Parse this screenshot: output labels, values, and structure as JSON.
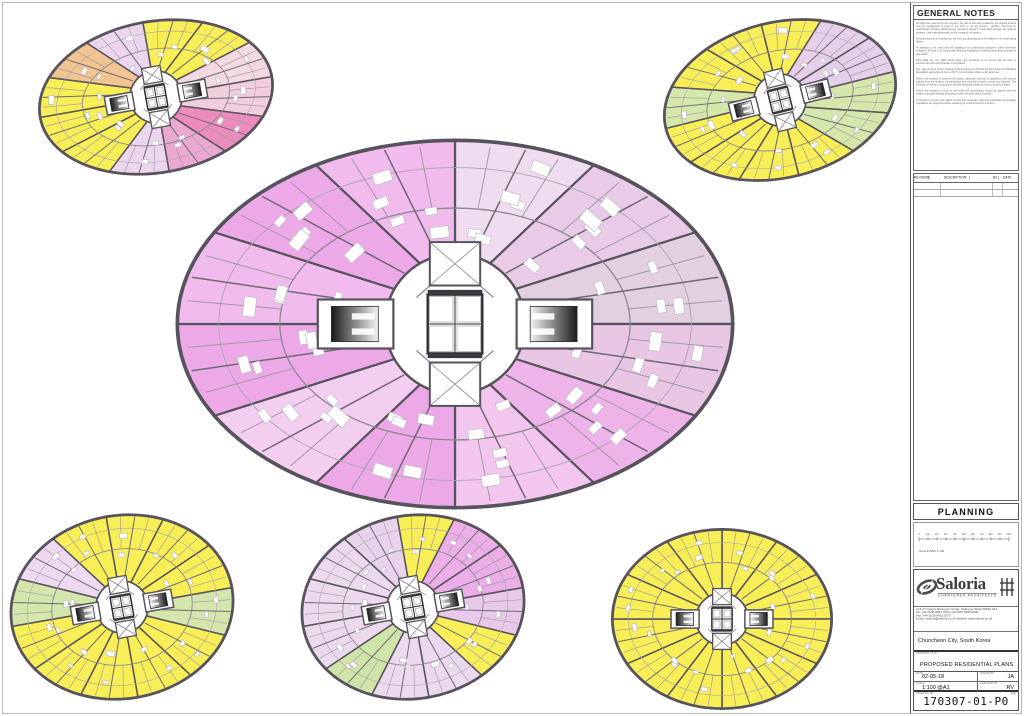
{
  "general_notes": {
    "title": "GENERAL NOTES",
    "paragraphs": [
      "All rights are reserved by the company. No part of this work created by the original artwork may be reproduced or used in any form or by any means - graphic, electronic or mechanical, including photocopying, recording, taping or information storage and retrieval systems - with right permission of the company concerned.",
      "All dimensions to be checked on site and any discrepancy to be notified to the supervising officer.",
      "All attention to be noted that this drawing is for construction purposes unless otherwise indicated. All work is to comply with Building Regulations including amendments made to date 2010.",
      "Party Wall etc. Act 1996 would apply any contractor is to ensure that all work is commenced with this schedule is completed.",
      "The main purpose of this drawing is the procurement of Planning Permission and Building Regulation approval and form a NOT to construction unless work approved.",
      "Where this property is used for the works, particulars should be acquired at the time of enquiry from the landlord, full particulars and schedule of work to avoid any disputes. The schedule of works in conjunction with the drawings should be used to resolve matters.",
      "Where this drawing is used for the works full specification should be agreed with the builder to include heating, plumbing & other services where required.",
      "Contractor to ensure that safety checks that necessary planning particulars and building regulations are approved before tendering or commencement of works."
    ]
  },
  "revision_table": {
    "columns": [
      "REVISION",
      "DESCRIPTION",
      "BY",
      "DATE"
    ]
  },
  "planning_label": "PLANNING",
  "scalebar": {
    "labels": [
      "0",
      "1m",
      "2m",
      "3m",
      "4m",
      "5m",
      "6m",
      "7m",
      "8m",
      "9m",
      "10m"
    ],
    "caption": "SCALE BAR 1:100"
  },
  "firm": {
    "name": "Saloria",
    "tagline": "CHARTERED ARCHITECTS",
    "address_line1": "Unit 27 Cygnus Business Centre, Dalmeyer Road NW10 2XA",
    "address_line2": "Tel:  +44 (020) 8451 7833    +44 (020) 8459 9600",
    "address_line3": "Fax: +44 (020) 8451 3375",
    "address_line4": "Email: l.saloria@saloria.co.uk    website: www.saloria.co.uk"
  },
  "project": {
    "location": "Chuncheon City, South Korea",
    "title_label": "DRAWING TITLE",
    "title": "PROPOSED  RESIDENTIAL  PLANS"
  },
  "fields": {
    "date_label": "DATE",
    "date": "02-05-18",
    "drawn_label": "DRAWN BY",
    "drawn": "JA",
    "scale_label": "SCALE",
    "scale": "1:100  @A1",
    "checked_label": "CHECKED BY",
    "checked": "RV",
    "number_label": "DRAWING NO",
    "rev_label": "REV",
    "drawing_number": "170307-01-P0"
  },
  "colors": {
    "wall": "#57535c",
    "yellow": "#f7ec55"
  },
  "plans": [
    {
      "name": "floor-plan-top-left",
      "cx": 156,
      "cy": 97,
      "rx": 118,
      "ry": 76,
      "rot": -10,
      "rc": 26,
      "big": false,
      "wedges": [
        [
          -90,
          -60,
          "#f8ee57"
        ],
        [
          -60,
          -30,
          "#f8ee57"
        ],
        [
          -30,
          0,
          "#f3d9e2"
        ],
        [
          0,
          30,
          "#f0cede"
        ],
        [
          30,
          60,
          "#ee8bbd"
        ],
        [
          60,
          90,
          "#eba8d0"
        ],
        [
          90,
          120,
          "#ecd6ee"
        ],
        [
          120,
          150,
          "#f8ee57"
        ],
        [
          150,
          180,
          "#f8ee57"
        ],
        [
          180,
          210,
          "#f8ee57"
        ],
        [
          210,
          240,
          "#f2c491"
        ],
        [
          240,
          270,
          "#ecd6ee"
        ]
      ]
    },
    {
      "name": "floor-plan-top-right",
      "cx": 780,
      "cy": 100,
      "rx": 118,
      "ry": 78,
      "rot": -14,
      "rc": 26,
      "big": false,
      "wedges": [
        [
          -90,
          -60,
          "#f8ee57"
        ],
        [
          -60,
          -30,
          "#e6cfe9"
        ],
        [
          -30,
          0,
          "#e6cfe9"
        ],
        [
          0,
          30,
          "#d6e7ab"
        ],
        [
          30,
          60,
          "#d6e7ab"
        ],
        [
          60,
          90,
          "#f8ee57"
        ],
        [
          90,
          120,
          "#f8ee57"
        ],
        [
          120,
          150,
          "#f8ee57"
        ],
        [
          150,
          180,
          "#f8ee57"
        ],
        [
          180,
          210,
          "#d6e7ab"
        ],
        [
          210,
          240,
          "#f8ee57"
        ],
        [
          240,
          270,
          "#f8ee57"
        ]
      ]
    },
    {
      "name": "floor-plan-typical-large",
      "cx": 455,
      "cy": 324,
      "rx": 278,
      "ry": 184,
      "rot": 0,
      "rc": 70,
      "big": true,
      "wedges": [
        [
          -90,
          -60,
          "#f0dcf0"
        ],
        [
          -60,
          -30,
          "#e9cbe7"
        ],
        [
          -30,
          0,
          "#e2cfe0"
        ],
        [
          0,
          30,
          "#e8c6e4"
        ],
        [
          30,
          60,
          "#eeb3e9"
        ],
        [
          60,
          90,
          "#f3c6ef"
        ],
        [
          90,
          120,
          "#eda9e7"
        ],
        [
          120,
          150,
          "#f4cef1"
        ],
        [
          150,
          180,
          "#eda9e7"
        ],
        [
          180,
          210,
          "#f1bbee"
        ],
        [
          210,
          240,
          "#eda9e7"
        ],
        [
          240,
          270,
          "#f1bbee"
        ]
      ]
    },
    {
      "name": "floor-plan-bottom-left",
      "cx": 122,
      "cy": 607,
      "rx": 112,
      "ry": 92,
      "rot": -10,
      "rc": 26,
      "big": false,
      "wedges": [
        [
          -90,
          -60,
          "#f8ee57"
        ],
        [
          -60,
          -30,
          "#f8ee57"
        ],
        [
          -30,
          0,
          "#f8ee57"
        ],
        [
          0,
          30,
          "#d4e6ab"
        ],
        [
          30,
          60,
          "#f8ee57"
        ],
        [
          60,
          90,
          "#f8ee57"
        ],
        [
          90,
          120,
          "#f8ee57"
        ],
        [
          120,
          150,
          "#f8ee57"
        ],
        [
          150,
          180,
          "#f8ee57"
        ],
        [
          180,
          210,
          "#d4e6ab"
        ],
        [
          210,
          240,
          "#eed9f0"
        ],
        [
          240,
          270,
          "#f8ee57"
        ]
      ]
    },
    {
      "name": "floor-plan-bottom-centre",
      "cx": 413,
      "cy": 607,
      "rx": 112,
      "ry": 92,
      "rot": -10,
      "rc": 26,
      "big": false,
      "wedges": [
        [
          -90,
          -60,
          "#f8ee57"
        ],
        [
          -60,
          -30,
          "#ebaee6"
        ],
        [
          -30,
          0,
          "#ebaee6"
        ],
        [
          0,
          30,
          "#e9c9e9"
        ],
        [
          30,
          60,
          "#f8ee57"
        ],
        [
          60,
          90,
          "#ecd9ee"
        ],
        [
          90,
          120,
          "#ecd9ee"
        ],
        [
          120,
          150,
          "#cfe4a8"
        ],
        [
          150,
          180,
          "#ecd9ee"
        ],
        [
          180,
          210,
          "#ecd9ee"
        ],
        [
          210,
          240,
          "#ecd9ee"
        ],
        [
          240,
          270,
          "#e9d2ec"
        ]
      ]
    },
    {
      "name": "floor-plan-bottom-right",
      "cx": 722,
      "cy": 619,
      "rx": 110,
      "ry": 90,
      "rot": 0,
      "rc": 26,
      "big": false,
      "wedges": [
        [
          -90,
          -60,
          "#f8ee57"
        ],
        [
          -60,
          -30,
          "#f8ee57"
        ],
        [
          -30,
          0,
          "#f8ee57"
        ],
        [
          0,
          30,
          "#f8ee57"
        ],
        [
          30,
          60,
          "#f8ee57"
        ],
        [
          60,
          90,
          "#f8ee57"
        ],
        [
          90,
          120,
          "#f8ee57"
        ],
        [
          120,
          150,
          "#f8ee57"
        ],
        [
          150,
          180,
          "#f8ee57"
        ],
        [
          180,
          210,
          "#f8ee57"
        ],
        [
          210,
          240,
          "#f8ee57"
        ],
        [
          240,
          270,
          "#f8ee57"
        ]
      ]
    }
  ]
}
